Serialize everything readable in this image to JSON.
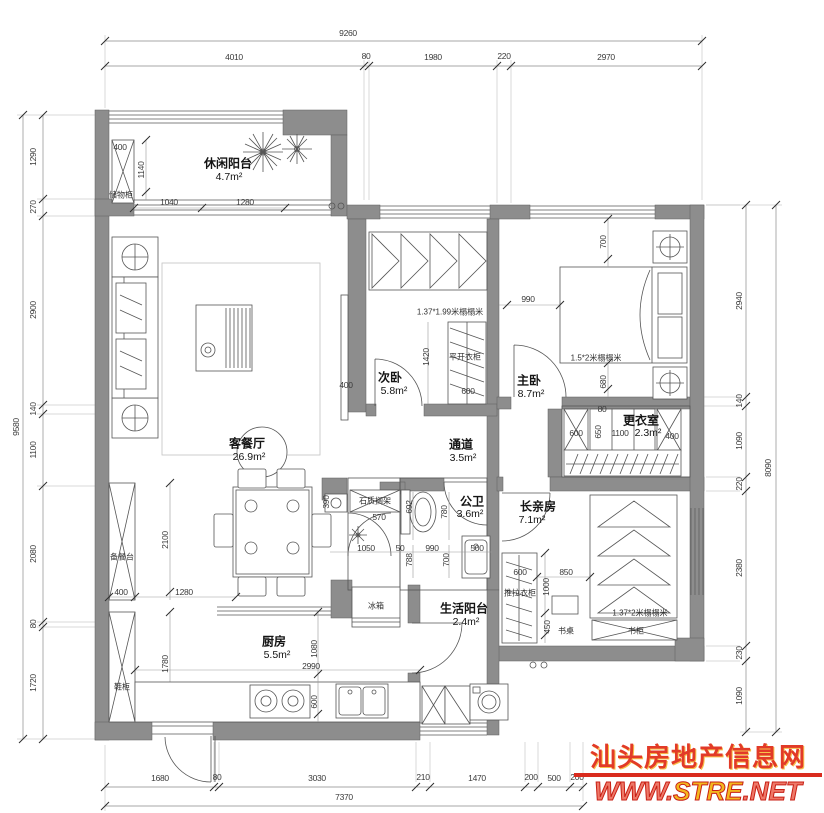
{
  "colors": {
    "wall_fill": "#8d8d8d",
    "line": "#555555",
    "dim_text": "#3a3a3a",
    "watermark_red": "#e23a28",
    "watermark_yellow": "#f3b71e"
  },
  "watermark": {
    "site_name": "汕头房地产信息网",
    "url_prefix": "WWW.",
    "url_brand": "STRE",
    "url_suffix": ".NET"
  },
  "rooms": {
    "leisure_balcony": {
      "name": "休闲阳台",
      "area": "4.7m²"
    },
    "living_dining": {
      "name": "客餐厅",
      "area": "26.9m²"
    },
    "second_bedroom": {
      "name": "次卧",
      "area": "5.8m²"
    },
    "master_bedroom": {
      "name": "主卧",
      "area": "8.7m²"
    },
    "corridor": {
      "name": "通道",
      "area": "3.5m²"
    },
    "dressing_room": {
      "name": "更衣室",
      "area": "2.3m²"
    },
    "bathroom": {
      "name": "公卫",
      "area": "3.6m²"
    },
    "elder_room": {
      "name": "长亲房",
      "area": "7.1m²"
    },
    "kitchen": {
      "name": "厨房",
      "area": "5.5m²"
    },
    "utility_balcony": {
      "name": "生活阳台",
      "area": "2.4m²"
    }
  },
  "annotations": {
    "storage_cabinet": "储物柜",
    "serving_counter": "备餐台",
    "shoe_cabinet": "鞋柜",
    "hinged_wardrobe": "平开衣柜",
    "sliding_wardrobe": "推拉衣柜",
    "bookcase": "书柜",
    "desk": "书桌",
    "fridge": "冰箱",
    "stone_shelf": "石质搁架",
    "tatami_second": "1.37*1.99米榻榻米",
    "tatami_master": "1.5*2米榻榻米",
    "tatami_elder": "1.37*2米榻榻米"
  },
  "dimensions": {
    "top": {
      "total": "9260",
      "segments": [
        "4010",
        "80",
        "1980",
        "220",
        "2970"
      ]
    },
    "left": {
      "total": "9580",
      "segments": [
        "1290",
        "270",
        "2900",
        "140",
        "1100",
        "2080",
        "80",
        "1720"
      ]
    },
    "right": {
      "total": "8090",
      "segments": [
        "2940",
        "140",
        "1090",
        "220",
        "2380",
        "230",
        "1090"
      ]
    },
    "bottom": {
      "total": "7370",
      "segments": [
        "1680",
        "80",
        "3030",
        "210",
        "1470",
        "200",
        "500",
        "200"
      ]
    },
    "interior": {
      "balcony_cabinet_width": "400",
      "balcony_depth": "1140",
      "balcony_win_a": "1040",
      "balcony_win_b": "1280",
      "living_counter_len": "2100",
      "living_wall": "1280",
      "living_counter_width": "400",
      "living_shoe_len": "1780",
      "tv_width": "400",
      "bed2_closet_depth": "1420",
      "bed2_closet_width": "600",
      "master_top": "700",
      "master_left": "990",
      "master_bottom": "680",
      "wall_gap": "80",
      "dress_a": "600",
      "dress_b": "650",
      "dress_c": "1100",
      "dress_d": "400",
      "bath_390": "390",
      "bath_570": "570",
      "bath_692": "692",
      "bath_780": "780",
      "bath_1050": "1050",
      "bath_50": "50",
      "bath_788": "788",
      "bath_990": "990",
      "bath_700": "700",
      "bath_500": "500",
      "elder_600": "600",
      "elder_1000": "1000",
      "elder_850": "850",
      "elder_450": "450",
      "kitchen_1080": "1080",
      "kitchen_2990": "2990",
      "kitchen_600": "600"
    }
  }
}
